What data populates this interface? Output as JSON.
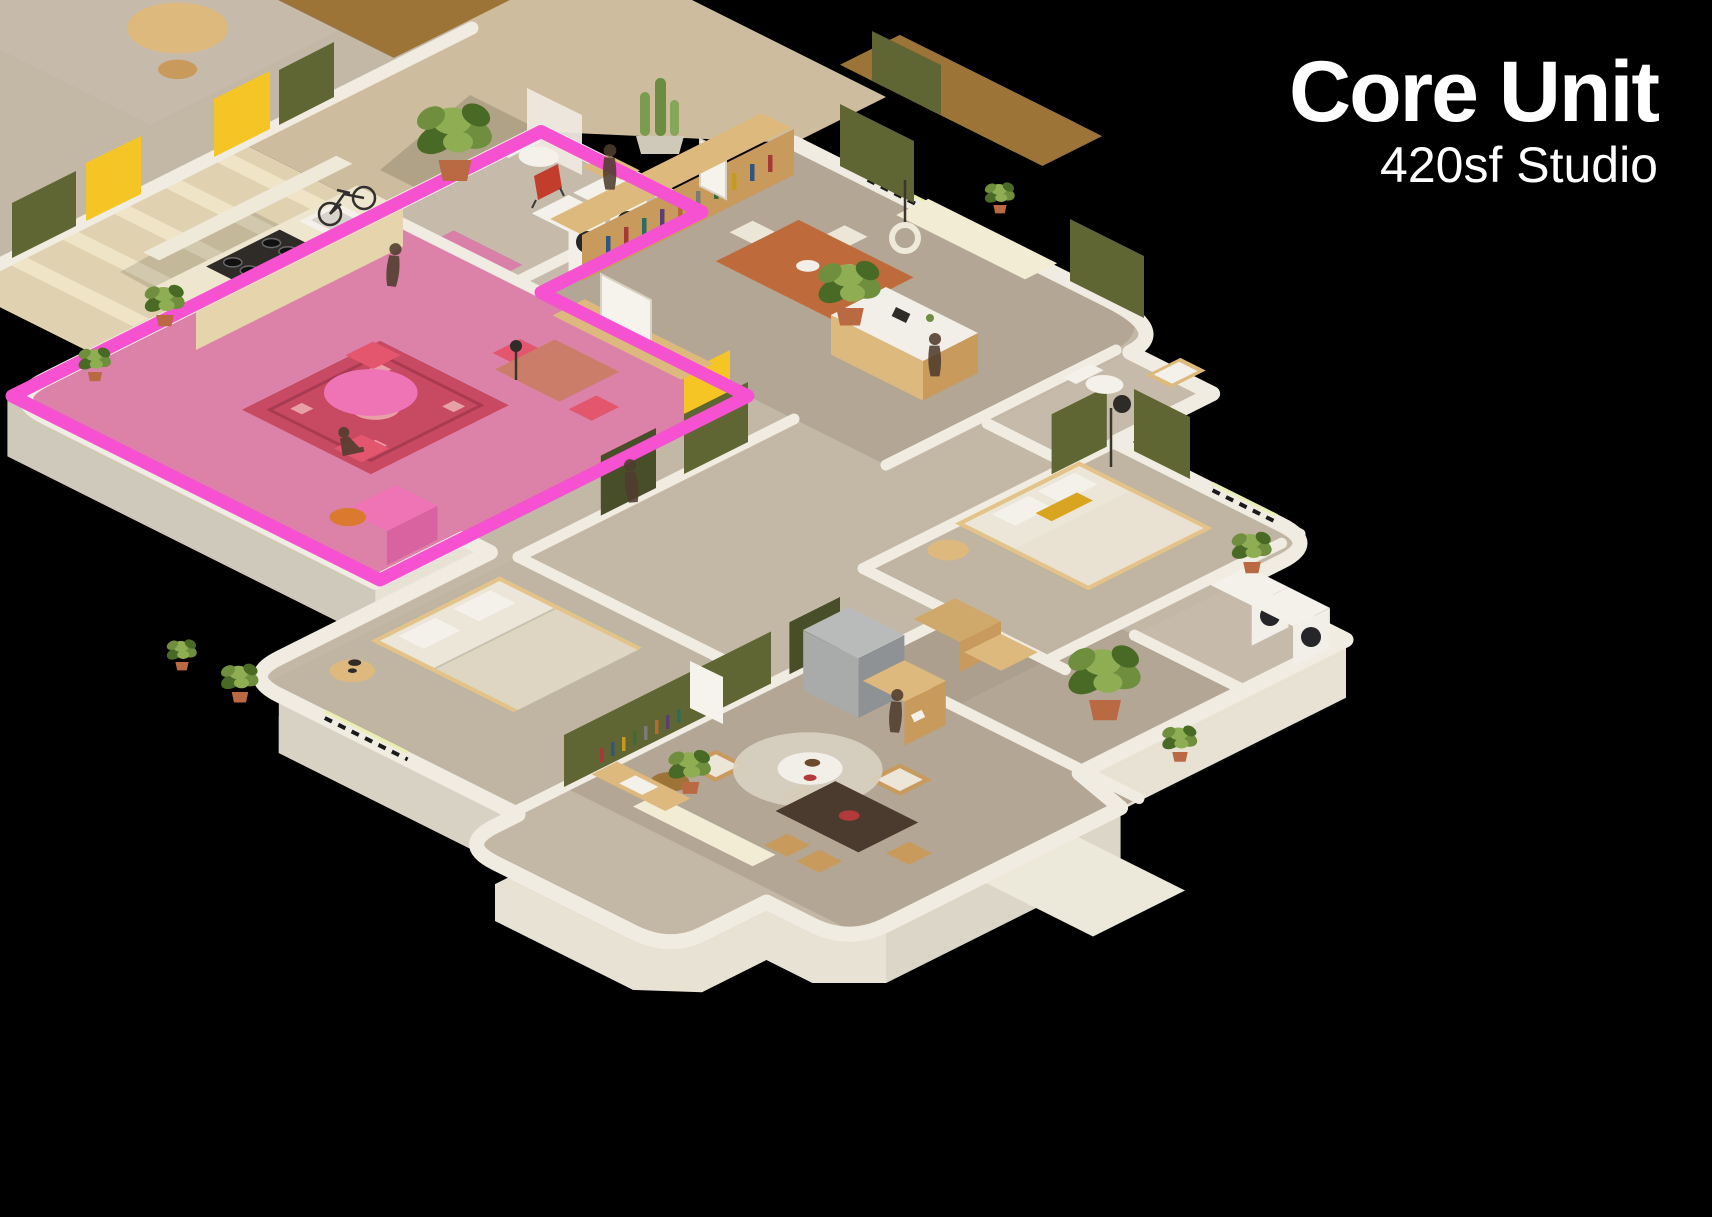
{
  "header": {
    "title": "Core Unit",
    "subtitle": "420sf Studio"
  },
  "highlight": {
    "unit": "core-studio-420sf",
    "outline_color": "#f551d1",
    "floor_color": "#e06aa8",
    "rug_color": "#c84a62",
    "rug_pattern_color": "#a83a52",
    "furniture_pink": "#ef74b6",
    "chair_pink": "#e4556e"
  },
  "palette": {
    "background": "#000000",
    "title_text": "#ffffff",
    "wall_white": "#f1ece2",
    "facade": "#e7e2d4",
    "facade_deep": "#cfc9bb",
    "floor_base": "#c3b8a6",
    "floor_concrete": "#b3a695",
    "floor_bedroom": "#c0b4a2",
    "courtyard_tan": "#cdbd9e",
    "walkway": "#e0d2b1",
    "step": "#efe4c6",
    "olive_green": "#5f6533",
    "olive_dark": "#484f28",
    "yellow_door": "#f4c524",
    "wood": "#c89a5c",
    "orange_table": "#bf6a3a",
    "linen": "#ece6d8",
    "pillow_yellow": "#d9a521",
    "plant_green": "#6f8f3f",
    "terracotta": "#b96a42",
    "appliance_white": "#f2efe8",
    "person": "#4f3d2d"
  },
  "scene": {
    "view": "isometric-cutaway-floorplan",
    "highlighted_room_ids": [
      "core-studio-kitchen",
      "core-studio-bathroom",
      "core-studio-living"
    ],
    "rooms": [
      {
        "id": "core-studio-kitchen",
        "name": "Core Unit Kitchen"
      },
      {
        "id": "core-studio-bathroom",
        "name": "Core Unit Bathroom / Laundry"
      },
      {
        "id": "core-studio-living",
        "name": "Core Unit Living / Dining"
      },
      {
        "id": "entry-hall",
        "name": "Entry Hall"
      },
      {
        "id": "living-dining",
        "name": "Living / Dining Room"
      },
      {
        "id": "bathroom",
        "name": "Bathroom"
      },
      {
        "id": "bedroom-1",
        "name": "Bedroom 1"
      },
      {
        "id": "bedroom-2",
        "name": "Bedroom 2"
      },
      {
        "id": "closet",
        "name": "Closet"
      },
      {
        "id": "laundry",
        "name": "Laundry"
      },
      {
        "id": "family-room",
        "name": "Family Room / Office"
      },
      {
        "id": "patio",
        "name": "Patio"
      },
      {
        "id": "courtyard",
        "name": "Courtyard / Walkway"
      },
      {
        "id": "neighbor-unit",
        "name": "Neighboring Unit"
      }
    ],
    "furniture": [
      "kitchen-counter-stove",
      "sink",
      "washer",
      "dryer",
      "toilet",
      "shower",
      "persian-rug",
      "round-table",
      "dining-table",
      "dresser",
      "bookshelf-sideboard",
      "kitchen-island",
      "orange-dining-table",
      "window-seat",
      "bed",
      "nightstand",
      "floor-lamp",
      "pendant-lamp",
      "coffee-table",
      "lounge-chairs",
      "dark-dining-table",
      "desk",
      "storage-boxes",
      "fridge",
      "cabinet",
      "entry-stoop"
    ],
    "plants_count": 12,
    "people_count": 6,
    "bicycle": true
  }
}
